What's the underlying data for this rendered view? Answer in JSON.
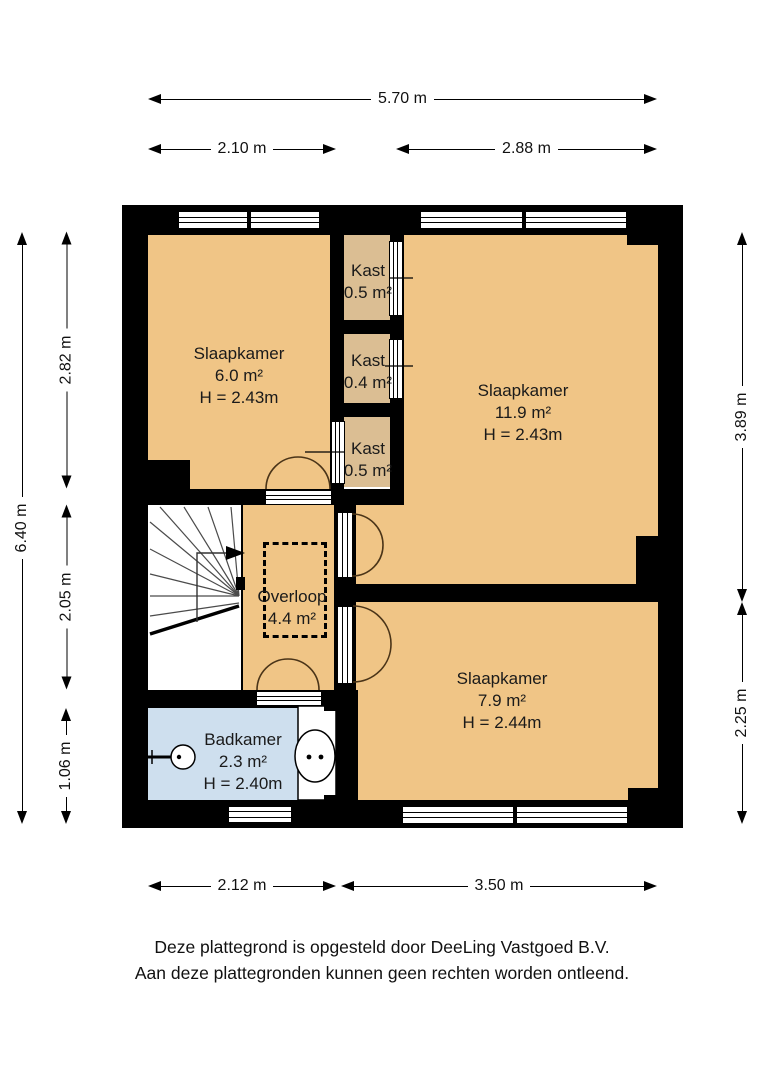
{
  "rooms": {
    "bedroom_top_left": {
      "name": "Slaapkamer",
      "area": "6.0 m²",
      "height": "H = 2.43m"
    },
    "bedroom_top_right": {
      "name": "Slaapkamer",
      "area": "11.9 m²",
      "height": "H = 2.43m"
    },
    "bedroom_bottom_right": {
      "name": "Slaapkamer",
      "area": "7.9 m²",
      "height": "H = 2.44m"
    },
    "bathroom": {
      "name": "Badkamer",
      "area": "2.3 m²",
      "height": "H = 2.40m"
    },
    "landing": {
      "name": "Overloop",
      "area": "4.4 m²"
    },
    "closet_top": {
      "name": "Kast",
      "area": "0.5 m²"
    },
    "closet_middle": {
      "name": "Kast",
      "area": "0.4 m²"
    },
    "closet_bottom": {
      "name": "Kast",
      "area": "0.5 m²"
    }
  },
  "dimensions": {
    "top_total": "5.70 m",
    "top_left": "2.10 m",
    "top_right": "2.88 m",
    "left_total": "6.40 m",
    "left_top": "2.82 m",
    "left_middle": "2.05 m",
    "left_bottom": "1.06 m",
    "right_top": "3.89 m",
    "right_bottom": "2.25 m",
    "bottom_left": "2.12 m",
    "bottom_right": "3.50 m"
  },
  "fixtures": [
    "stairs-up-arrow",
    "sink",
    "toilet",
    "dashed-ceiling-zone"
  ],
  "colors": {
    "wall": "#000000",
    "room_floor": "#F0C586",
    "closet_floor": "#DBBE93",
    "bathroom_floor": "#CEDFEE",
    "text": "#111111"
  },
  "footer": {
    "line1": "Deze plattegrond is opgesteld door DeeLing Vastgoed B.V.",
    "line2": "Aan deze plattegronden kunnen geen rechten worden ontleend."
  }
}
